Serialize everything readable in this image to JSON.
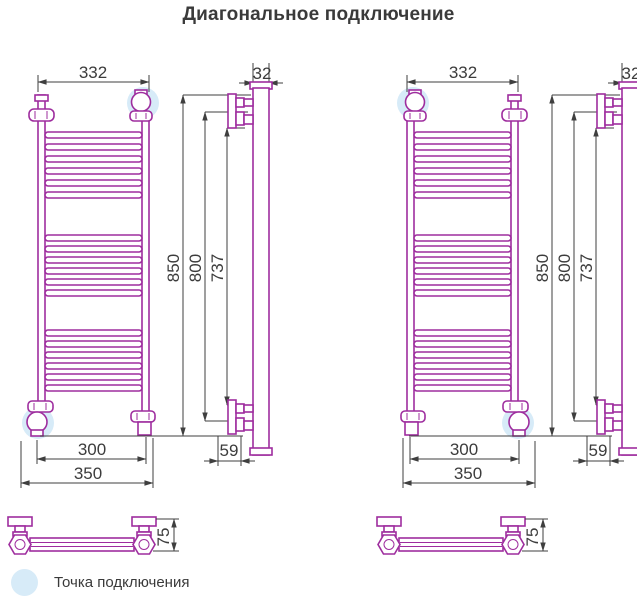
{
  "title": "Диагональное подключение",
  "legend": {
    "marker": "connection-point-highlight",
    "label": "Точка подключения"
  },
  "colors": {
    "pipe_outline": "#9e2d9e",
    "dimension_lines": "#3f3f3f",
    "connection_highlight": "#d7ebf8",
    "text": "#3a3a3a",
    "background": "#ffffff"
  },
  "dims": {
    "top_width": "332",
    "pitch_width": "300",
    "overall_width": "350",
    "overall_height": "850",
    "mounting_height": "800",
    "inner_height": "737",
    "pipe_diameter": "32",
    "wall_offset": "59",
    "depth": "75"
  },
  "drawings": [
    {
      "name": "left-variant",
      "connection_points": [
        "top-right",
        "bottom-left"
      ]
    },
    {
      "name": "right-variant",
      "connection_points": [
        "top-left",
        "bottom-right"
      ]
    }
  ]
}
